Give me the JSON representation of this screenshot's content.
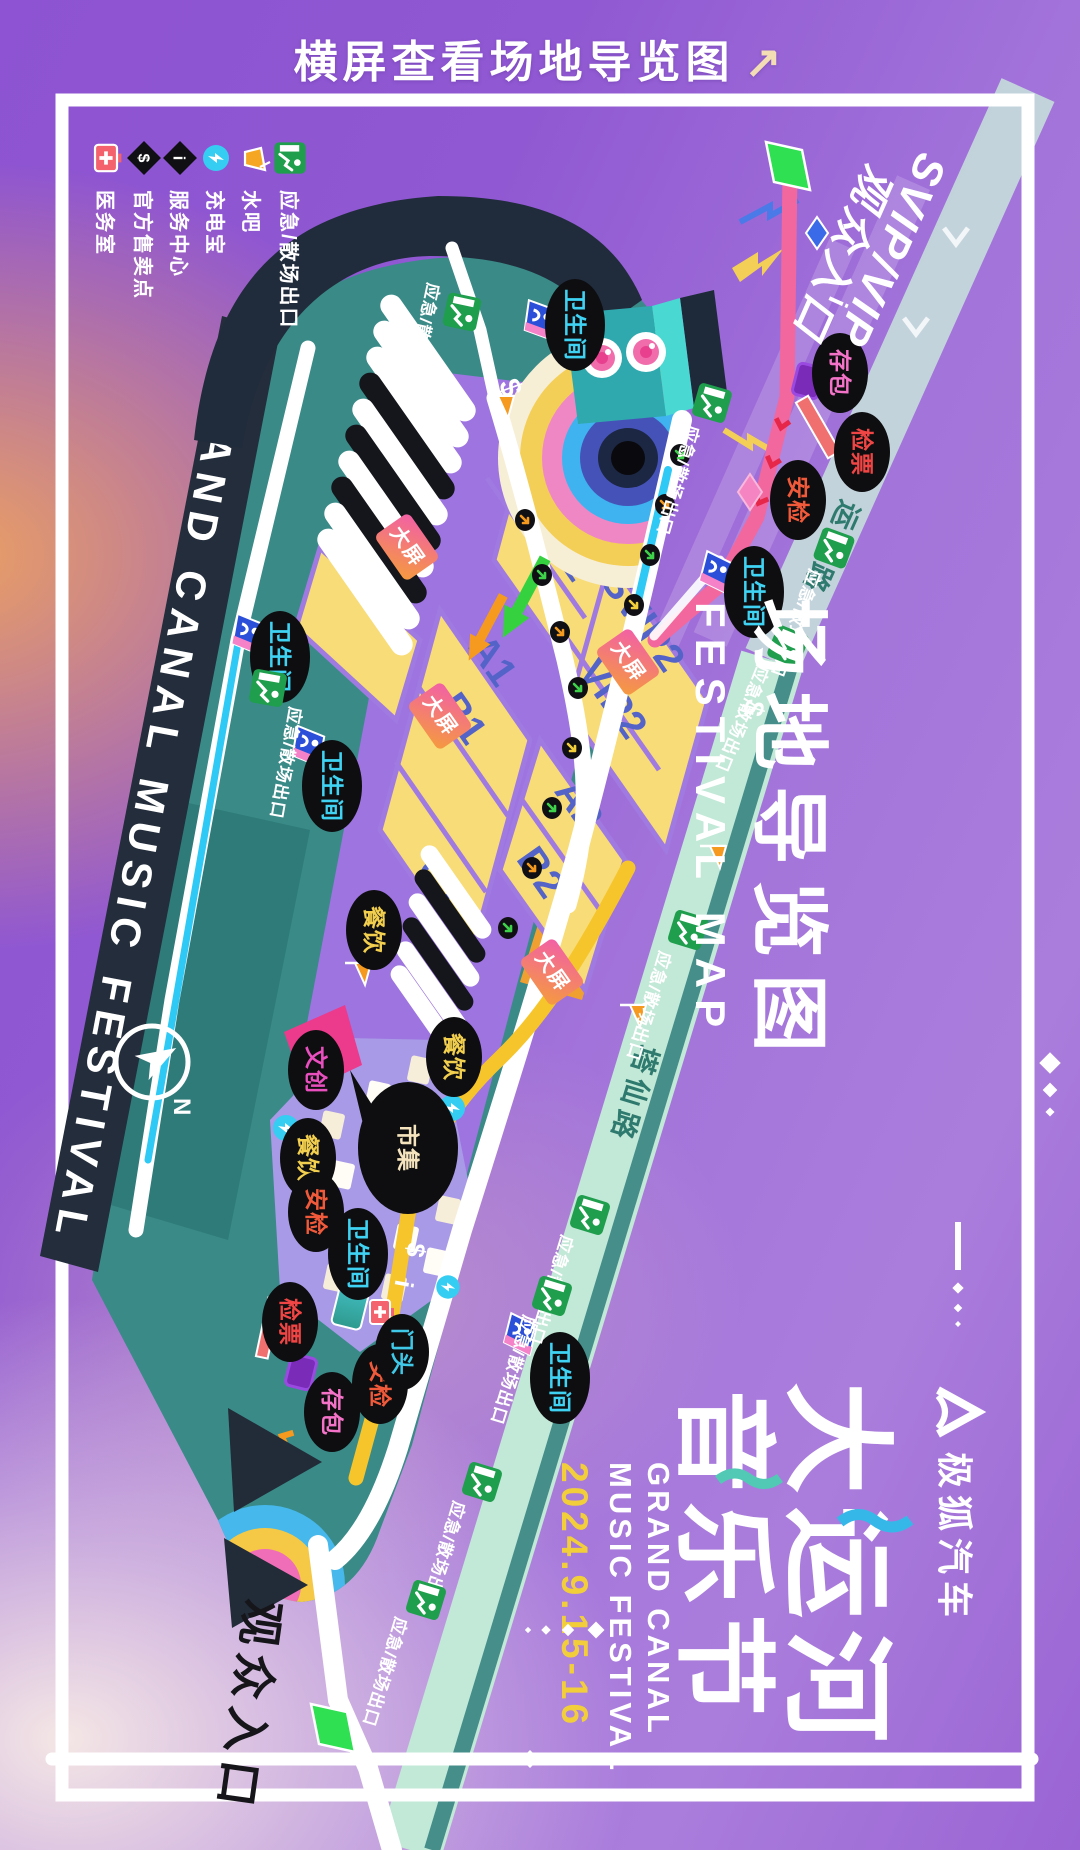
{
  "instruction": {
    "text": "横屏查看场地导览图"
  },
  "map_title": {
    "zh": "场地导览图",
    "en": "FESTIVAL MAP"
  },
  "stage_band": {
    "text": "GRAND CANAL MUSIC FESTIVAL"
  },
  "entrances": {
    "svip_line1": "SVIP/VIP",
    "svip_line2": "观众入口",
    "audience": "观众入口"
  },
  "roads": {
    "yunxing": "运兴路",
    "taxian": "塔仙路"
  },
  "zones": {
    "svip1": "SVIP1",
    "svip2": "SVIP2",
    "vip1": "VIP1",
    "vip2": "VIP2",
    "a1": "A1",
    "a2": "A2",
    "b1": "B1",
    "b2": "B2",
    "c1": "C1",
    "c2": "C2"
  },
  "labels": {
    "toilet": "卫生间",
    "exit": "应急/散场出口",
    "screen": "大屏",
    "food": "餐饮",
    "security": "安检",
    "ticket": "检票",
    "bag": "存包",
    "market": "市集",
    "cultural": "文创",
    "gate": "门头"
  },
  "markers": {
    "dollar": "$",
    "info": "i",
    "compass_n": "N"
  },
  "legend": {
    "items": [
      {
        "icon": "exit-icon",
        "label": "应急/散场出口"
      },
      {
        "icon": "drink-icon",
        "label": "水吧"
      },
      {
        "icon": "charger-icon",
        "label": "充电宝"
      },
      {
        "icon": "info-icon",
        "label": "服务中心"
      },
      {
        "icon": "sales-icon",
        "label": "官方售卖点"
      },
      {
        "icon": "medical-icon",
        "label": "医务室"
      }
    ]
  },
  "branding": {
    "sponsor": "极狐汽车",
    "title_line1": "大运河",
    "title_line2": "音乐节",
    "en_line1": "GRAND CANAL",
    "en_line2": "MUSIC FESTIVAL",
    "date": "2024.9.15-16"
  },
  "colors": {
    "accent_pink": "#f2679d",
    "accent_yellow": "#f6c52b",
    "exit_green": "#1f9e4d",
    "road_cyan": "#2fc9f5",
    "venue_teal": "#3a8a88",
    "zone_yellow": "#f8dc78",
    "date_yellow": "#f2cf3a"
  }
}
